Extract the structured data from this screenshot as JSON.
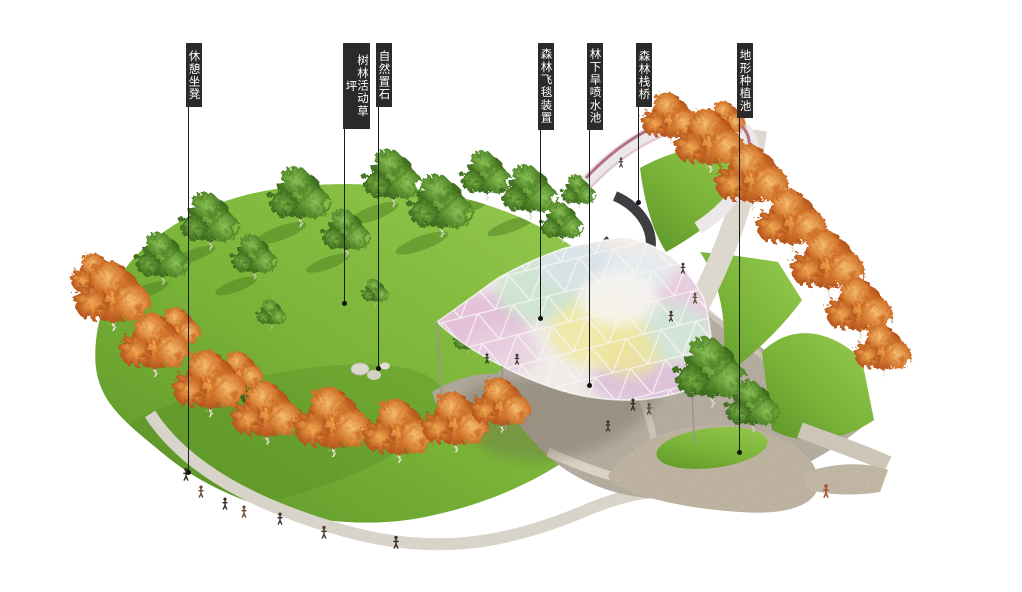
{
  "figure": {
    "kind": "landscape-design-aerial-rendering",
    "background": "#ffffff"
  },
  "annotations": [
    {
      "id": "rest-bench",
      "label": "休憩坐凳"
    },
    {
      "id": "forest-activity-lawn",
      "label": "树林活动草坪"
    },
    {
      "id": "natural-placed-stones",
      "label": "自然置石"
    },
    {
      "id": "forest-flying-carpet",
      "label": "森林飞毯装置"
    },
    {
      "id": "forest-dry-fountain",
      "label": "林下旱喷水池"
    },
    {
      "id": "forest-boardwalk",
      "label": "森林栈桥"
    },
    {
      "id": "terrain-planting-pool",
      "label": "地形种植池"
    }
  ],
  "colors": {
    "label_box": "#2b2a28",
    "label_text": "#ffffff",
    "lawn": "#7db437",
    "lawn_dark": "#55882a",
    "autumn_tree": "#c25a1c",
    "green_tree": "#4c7f26",
    "plaza": "#bcb4a6",
    "gravel": "#c8bca7",
    "path": "#d8d4c9",
    "canopy_pink": "#e3bfd9",
    "canopy_mint": "#cde4d0",
    "canopy_yellow": "#f0e9a6",
    "canopy_blue": "#d7e2e9",
    "boardwalk_rail": "#d9bacb"
  }
}
